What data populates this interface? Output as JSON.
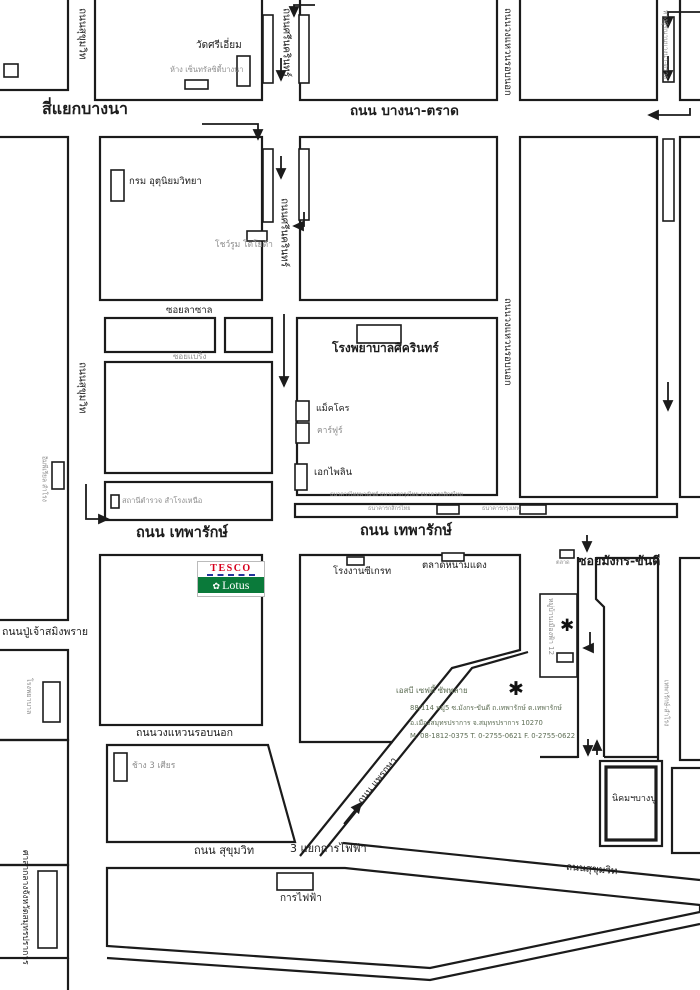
{
  "roads": {
    "bangna_trad": "ถนน บางนา-ตราด",
    "bangna_junction": "สี่แยกบางนา",
    "sukhumvit_top_v": "ถนนสุขุมวิท",
    "sukhumvit_mid_v": "ถนนสุขุมวิท",
    "sukhumvit_lower_h": "ถนน สุขุมวิท",
    "sukhumvit_se": "ถนนสุขุมวิท",
    "srinakarin_top": "ถนนศรีนครินทร์",
    "srinakarin_mid": "ถนนศรีนครินทร์",
    "ringroad_top": "ถนนวงแหวนรอบนอก",
    "ringroad_mid": "ถนนวงแหวนรอบนอก",
    "ringroad_lower": "ถนนวงแหวนรอบนอก",
    "frontage_top": "ทางคู่ขนานบางนา-ตราด",
    "thepharak_w": "ถนน เทพารักษ์",
    "thepharak_e": "ถนน เทพารักษ์",
    "mangkorn": "ซอยมังกร-ขันดี",
    "lasalle": "ซอยลาซาล",
    "bearing": "ซอยแบริ่ง",
    "pujao": "ถนนปู่เจ้าสมิงพราย",
    "praksa": "ถนน แพรกษา",
    "kanfaifa_junction": "3 แยกการไฟฟ้า",
    "thepharak_samrong": "เทพารักษ์-สำโรง"
  },
  "places": {
    "wat_sri_iam": "วัดศรีเอี่ยม",
    "central_city": "ห้าง เซ็นทรัลซิตี้บางนา",
    "meteorological_dept": "กรม อุตุนิยมวิทยา",
    "toyota_showroom": "โชว์รูม โตโยต้า",
    "sikarin_hospital": "โรงพยาบาลศิครินทร์",
    "makro": "แม็คโคร",
    "carrefour": "คาร์ฟูร์",
    "ek_pailin": "เอกไพลิน",
    "police_station": "สถานีตำรวจ สำโรงเหนือ",
    "imperial_samrong": "อิมพีเรียล สำโรง",
    "banks_row": "ธนาคารไทยพาณิชย์ ธนาคารกรุงไทย ธนาคารกสิกรไทย",
    "bank1": "ธนาคารกสิกรไทย",
    "bank2": "ธนาคารกรุงเทพ",
    "seagate_factory": "โรงงานซีเกรท",
    "namdaeng_market": "ตลาดหนามแดง",
    "market_small": "ตลาด",
    "village": "หมู่บ้านเมืองฟ้า 12",
    "hospital_left": "โรงพยาบาล",
    "erawan_elephant": "ช้าง 3 เศียร",
    "electricity_authority": "การไฟฟ้า",
    "city_hall": "ศาลากลางจังหวัดสมุทรปราการ",
    "bangpu_estate": "นิคมฯบางปู"
  },
  "destination": {
    "name": "เอสบี เซฟตี้ ซัพพลาย",
    "address_line1": "88/114 หมู่5 ซ.มังกร-ขันดี ถ.เทพารักษ์ ต.เทพารักษ์",
    "address_line2": "อ.เมืองสมุทรปราการ จ.สมุทรปราการ 10270",
    "contact": "M. 08-1812-0375  T. 0-2755-0621 F. 0-2755-0622",
    "marker": "✱"
  },
  "logo": {
    "brand_top": "TESCO",
    "brand_bottom": "Lotus",
    "flower_icon": "✿",
    "colors": {
      "tesco_red": "#d6001c",
      "dash_blue": "#24349c",
      "lotus_green": "#0a7a3a"
    }
  }
}
